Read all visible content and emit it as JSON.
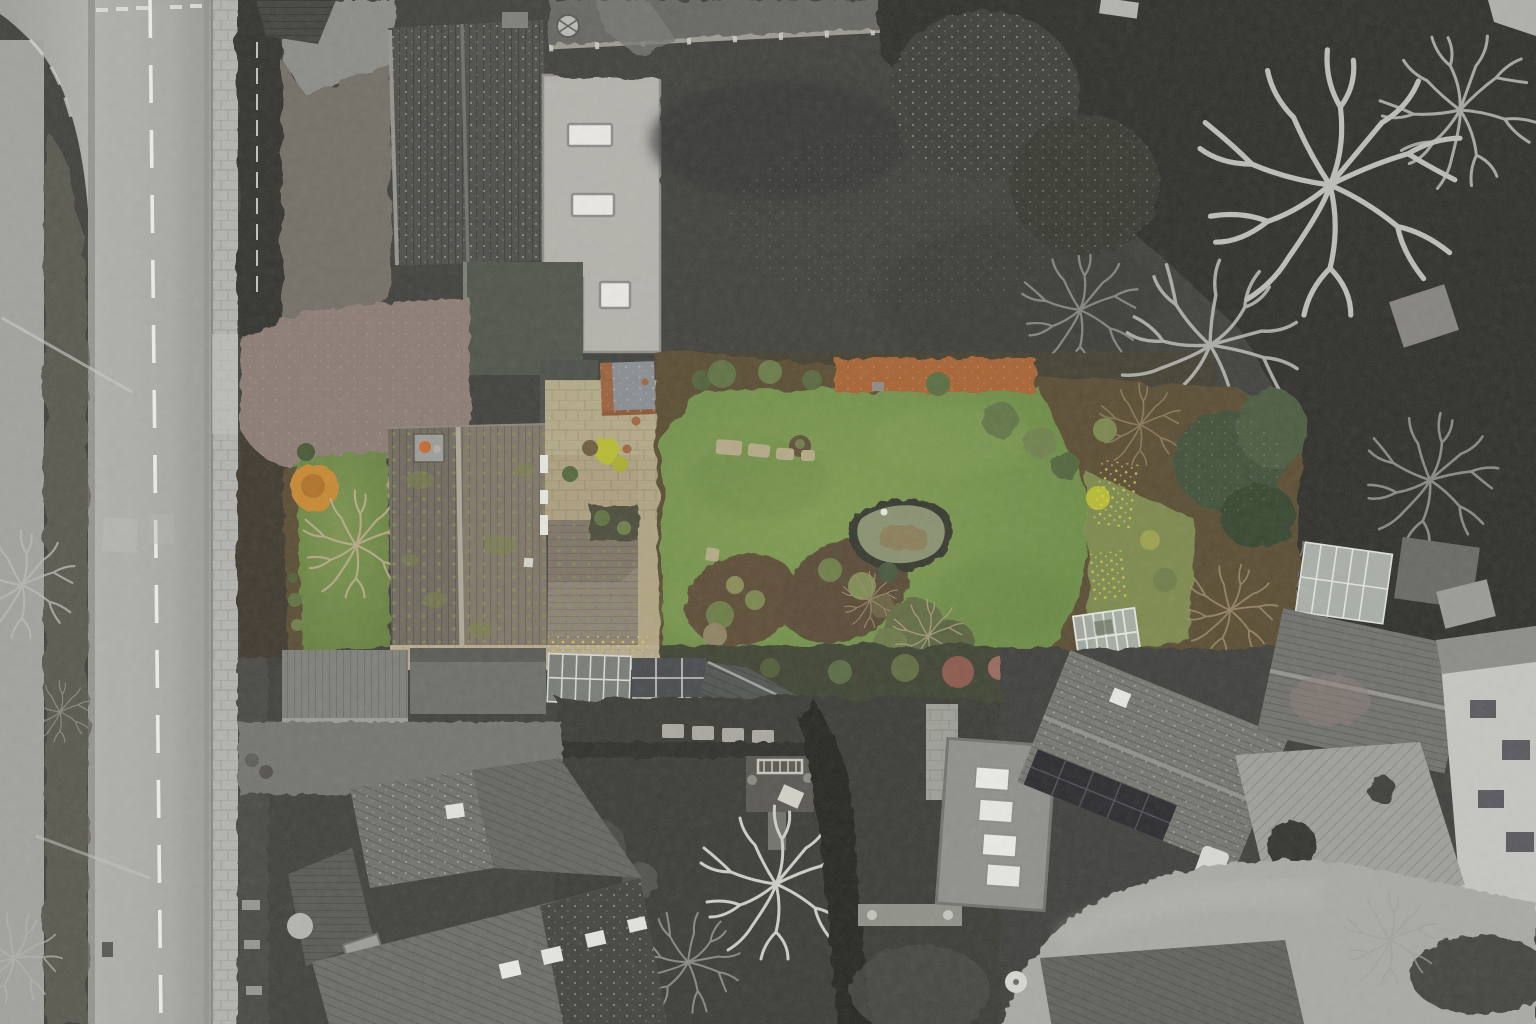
{
  "scene": {
    "type": "aerial-drone-photograph",
    "style": "selective-colour real-estate aerial photo: the featured house and its long rear garden are rendered in colour while the road, neighbouring houses and mature trees are desaturated greyscale",
    "orientation": "top-down (nadir) view, winter season",
    "features": [
      {
        "id": "main-road",
        "label": "Main road with dashed centre line"
      },
      {
        "id": "grass-verge",
        "label": "Grass verge and footpath"
      },
      {
        "id": "stone-barn",
        "label": "Dark tiled barn roof"
      },
      {
        "id": "flat-outbuilding",
        "label": "Light flat-roof outbuilding with three skylights"
      },
      {
        "id": "walled-field",
        "label": "Dark walled paddock"
      },
      {
        "id": "featured-house",
        "label": "Featured house with mossy tiled roof and chimney"
      },
      {
        "id": "driveway",
        "label": "Private driveway from road"
      },
      {
        "id": "front-lawn",
        "label": "Front lawn with amber shrub"
      },
      {
        "id": "patio",
        "label": "Stone patio with bistro table and shed"
      },
      {
        "id": "rear-garden",
        "label": "Long rear lawn with island flower beds"
      },
      {
        "id": "pond",
        "label": "Kidney-shaped garden pond"
      },
      {
        "id": "autumn-hedge",
        "label": "Copper beech hedge along border"
      },
      {
        "id": "greenhouse",
        "label": "Small glass greenhouse"
      },
      {
        "id": "conifers",
        "label": "Green conifers at far end of garden"
      },
      {
        "id": "winter-trees",
        "label": "Bare winter trees (greyscale)"
      },
      {
        "id": "neighbour-houses",
        "label": "Neighbouring grey houses, garages and conservatories"
      },
      {
        "id": "solar-house",
        "label": "Neighbour roof with solar panels"
      },
      {
        "id": "white-house",
        "label": "White rendered house at right edge"
      },
      {
        "id": "cul-de-sac",
        "label": "Curving cul-de-sac road bottom right"
      }
    ]
  },
  "palette": {
    "base_dark": "#3c3c38",
    "road": "#a6a6a2",
    "road_marking": "#efefe9",
    "sidewalk": "#b2b2ae",
    "verge": "#55544c",
    "pavement_path": "#a0a09c",
    "field_dark": "#3d3d39",
    "stone_wall": "#9b998f",
    "hedge_dark": "#2e2e29",
    "tree_canopy_dark": "#2a2a26",
    "conifer_gray": "#3a3a35",
    "bare_branches": "#c3c3bd",
    "barn_roof": "#4a4a46",
    "flat_roof_light": "#b5b2ac",
    "skylight_white": "#eceae4",
    "upper_field": "#64645e",
    "rough_ground": "#6f6c64",
    "driveway": "#8a7a71",
    "front_lawn": "#6f8c44",
    "garden_lawn": "#74924a",
    "garden_soil": "#57492f",
    "house_roof_left": "#6e675c",
    "house_roof_right": "#7e7466",
    "roof_ridge": "#b2ab9c",
    "extension_roof_hi": "#8b8071",
    "extension_roof_lo": "#7d7264",
    "chimney_pot_orange": "#c4672e",
    "orange_bush": "#c8872f",
    "orange_hedge": "#a7602e",
    "patio": "#b3a985",
    "front_path": "#b7ab8d",
    "shed_roof": "#878c90",
    "shed_trim": "#9a5f3a",
    "garden_room_roof": "#4c5146",
    "pond_edge": "#33352c",
    "pond_water": "#87906e",
    "pond_reeds": "#8a7a52",
    "conifer_green": "#3c4e34",
    "shrub_green": "#5c7040",
    "shrub_yellow": "#b6bb2e",
    "red_shrub": "#8a5648",
    "greenhouse_glass": "#aab3ac",
    "greenhouse_frame": "#e6e8e2",
    "carport_roof": "#7d7d78",
    "garage_roof": "#6b6c66",
    "conservatory": "#777a74",
    "lean_to_glass": "#44474a",
    "long_roof": "#4e524e",
    "neighbor_garden": "#373732",
    "gray_house_roof": "#6a6a65",
    "gray_roof_north": "#6f6f6a",
    "dark_gable": "#3f3f3b",
    "chimney_brick": "#9b9b96",
    "flat_roof_gray": "#8e8e89",
    "big_roof_gray": "#74746e",
    "solar_panel": "#26262a",
    "white_house": "#c6c6c1",
    "block_paving": "#9e9e99",
    "road_curve": "#a8a8a4",
    "small_house_roof": "#5e5e59",
    "bench_frame": "#c9c9c0",
    "table_top": "#9aa0a0",
    "chair_dark": "#3f444c",
    "terracotta": "#a06038"
  }
}
